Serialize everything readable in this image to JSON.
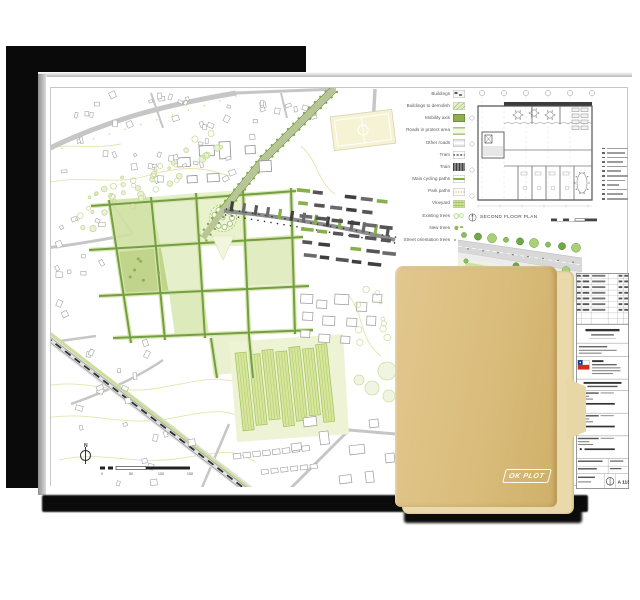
{
  "sheet": {
    "legend": {
      "items": [
        {
          "key": "buildings",
          "label": "Buildings"
        },
        {
          "key": "buildings-demolish",
          "label": "Buildings to demolish"
        },
        {
          "key": "mobility-axis",
          "label": "Mobility axis"
        },
        {
          "key": "roads-protect",
          "label": "Roads in protect area"
        },
        {
          "key": "other-roads",
          "label": "Other roads"
        },
        {
          "key": "tram",
          "label": "Tram"
        },
        {
          "key": "train",
          "label": "Train"
        },
        {
          "key": "cycling-paths",
          "label": "Main cycling paths"
        },
        {
          "key": "park-paths",
          "label": "Park paths"
        },
        {
          "key": "vineyard",
          "label": "Vineyard"
        },
        {
          "key": "existing-trees",
          "label": "Existing trees"
        },
        {
          "key": "new-trees",
          "label": "New trees"
        },
        {
          "key": "street-trees",
          "label": "Street orientation trees"
        }
      ]
    },
    "map": {
      "north_label": "N",
      "scale_labels": [
        "0",
        "50",
        "100",
        "150"
      ]
    },
    "floor_plan": {
      "caption": "SECOND FLOOR PLAN"
    },
    "title_block": {
      "sheet_number": "A 113",
      "flag_icon": "chile-flag-icon",
      "flag_colors": {
        "blue": "#0032A0",
        "red": "#D52B1E"
      }
    }
  },
  "folder": {
    "logo_text": "OK PLOT",
    "front_color": "#DABD7C",
    "back_color": "#E9D9AB"
  },
  "palette": {
    "green_dark": "#6F9B3E",
    "green_mid": "#8FB94F",
    "green_light": "#D8E7AC",
    "road_gray": "#BDBDBD",
    "contour_yellow": "#E6E2AB",
    "backing_black": "#0A0A0A"
  }
}
